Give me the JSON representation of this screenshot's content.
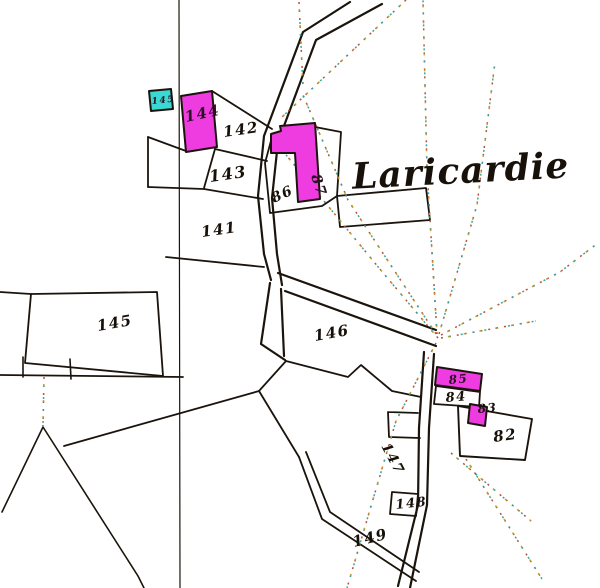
{
  "map": {
    "title_label": "Laricardie",
    "colors": {
      "paper": "#ffffff",
      "ink": "#1b140c",
      "building_magenta": "#ee3ce1",
      "building_cyan": "#3bd9d4",
      "label_ink": "#171008",
      "label_on_magenta": "#2a1022",
      "dotted_red": "#b14a28",
      "dotted_teal": "#2fa39a",
      "dotted_yellow": "#c49b25"
    },
    "parcel_labels": [
      {
        "name": "parcel-label-144",
        "text": "144",
        "x": 186,
        "y": 122,
        "rot": -12,
        "size": 15,
        "on_building": true
      },
      {
        "name": "parcel-label-142",
        "text": "142",
        "x": 224,
        "y": 137,
        "rot": -8,
        "size": 15,
        "on_building": false
      },
      {
        "name": "parcel-label-143",
        "text": "143",
        "x": 210,
        "y": 182,
        "rot": -8,
        "size": 16,
        "on_building": false
      },
      {
        "name": "parcel-label-141",
        "text": "141",
        "x": 202,
        "y": 237,
        "rot": -8,
        "size": 15,
        "on_building": false
      },
      {
        "name": "parcel-label-86",
        "text": "86",
        "x": 274,
        "y": 203,
        "rot": -25,
        "size": 14,
        "on_building": false
      },
      {
        "name": "parcel-label-87",
        "text": "87",
        "x": 311,
        "y": 176,
        "rot": 72,
        "size": 14,
        "on_building": true
      },
      {
        "name": "parcel-label-145",
        "text": "145",
        "x": 98,
        "y": 331,
        "rot": -10,
        "size": 15,
        "on_building": false
      },
      {
        "name": "building-label-145",
        "text": "145",
        "x": 152,
        "y": 104,
        "rot": -6,
        "size": 9,
        "on_building": true
      },
      {
        "name": "parcel-label-146",
        "text": "146",
        "x": 315,
        "y": 341,
        "rot": -10,
        "size": 15,
        "on_building": false
      },
      {
        "name": "parcel-label-147",
        "text": "147",
        "x": 381,
        "y": 446,
        "rot": 62,
        "size": 14,
        "on_building": false
      },
      {
        "name": "parcel-label-148",
        "text": "148",
        "x": 396,
        "y": 509,
        "rot": -6,
        "size": 13,
        "on_building": false
      },
      {
        "name": "parcel-label-149",
        "text": "149",
        "x": 354,
        "y": 547,
        "rot": -14,
        "size": 15,
        "on_building": false
      },
      {
        "name": "parcel-label-85",
        "text": "85",
        "x": 449,
        "y": 384,
        "rot": -5,
        "size": 12,
        "on_building": true
      },
      {
        "name": "parcel-label-84",
        "text": "84",
        "x": 446,
        "y": 402,
        "rot": -5,
        "size": 13,
        "on_building": false
      },
      {
        "name": "parcel-label-83",
        "text": "83",
        "x": 478,
        "y": 413,
        "rot": -5,
        "size": 12,
        "on_building": false
      },
      {
        "name": "parcel-label-82",
        "text": "82",
        "x": 494,
        "y": 442,
        "rot": -8,
        "size": 15,
        "on_building": false
      }
    ],
    "roads": [
      {
        "name": "road-main-west-edge",
        "d": "M350,2 L303,32 L264,136 L258,196 L264,254 L271,280"
      },
      {
        "name": "road-main-east-edge",
        "d": "M382,4 L316,40 L278,142 L272,198 L277,254 L282,285"
      },
      {
        "name": "road-branch-north-edge",
        "d": "M278,273 L436,330"
      },
      {
        "name": "road-branch-south-edge",
        "d": "M285,291 L436,346"
      },
      {
        "name": "road-south-west-edge",
        "d": "M270,283 L261,344 L285,360"
      },
      {
        "name": "road-south-east-edge",
        "d": "M281,289 L284,356"
      },
      {
        "name": "road-down-west-edge",
        "d": "M424,352 L419,428 L418,505 L398,586"
      },
      {
        "name": "road-down-east-edge",
        "d": "M434,354 L429,428 L427,505 L410,588"
      }
    ],
    "boundaries": [
      {
        "name": "section-line-vertical",
        "d": "M179,0 L180,588",
        "w": 1.2
      },
      {
        "name": "boundary-142-top",
        "d": "M212,91 L272,129",
        "w": 1.8
      },
      {
        "name": "boundary-142-143",
        "d": "M215,149 L267,161",
        "w": 1.8
      },
      {
        "name": "boundary-143-left",
        "d": "M215,149 L204,188",
        "w": 1.8
      },
      {
        "name": "boundary-143-bottom",
        "d": "M148,187 L204,189 L263,199",
        "w": 1.8
      },
      {
        "name": "boundary-left-small-vertical",
        "d": "M148,137 L148,187",
        "w": 1.8
      },
      {
        "name": "boundary-left-small-diagonal",
        "d": "M148,137 L186,151",
        "w": 1.8
      },
      {
        "name": "boundary-141-bottom",
        "d": "M166,257 L264,267",
        "w": 1.8
      },
      {
        "name": "plot-86-outline",
        "d": "M265,163 L272,137 L315,127 L341,132 L337,196 L322,206 L270,213 Z",
        "w": 1.8
      },
      {
        "name": "plot-86-right-outline",
        "d": "M337,196 L426,188 L430,220 L340,227 Z",
        "w": 1.8
      },
      {
        "name": "boundary-146-south-zigzag",
        "d": "M286,361 L348,377 L361,365 L392,391 L421,397",
        "w": 1.8
      },
      {
        "name": "boundary-149-north",
        "d": "M64,446 L259,391 L286,361",
        "w": 1.8
      },
      {
        "name": "boundary-147-west",
        "d": "M259,391 L299,457",
        "w": 1.8
      },
      {
        "name": "path-149-southeast-a",
        "d": "M299,457 L322,519 L416,581",
        "w": 1.8
      },
      {
        "name": "path-149-southeast-b",
        "d": "M306,452 L330,512 L419,572",
        "w": 1.8
      },
      {
        "name": "boundary-bottomleft-horizontal",
        "d": "M0,375 L183,377",
        "w": 1.8
      },
      {
        "name": "boundary-tick-a",
        "d": "M23,357 L23,377",
        "w": 1.6
      },
      {
        "name": "boundary-tick-b",
        "d": "M70,359 L71,379",
        "w": 1.6
      },
      {
        "name": "parcel-145-outline",
        "d": "M31,294 L157,292 L163,376 L25,363 Z",
        "w": 1.8
      },
      {
        "name": "boundary-145-west-extension",
        "d": "M0,292 L31,294",
        "w": 1.8
      },
      {
        "name": "boundary-v-lines",
        "d": "M2,512 L43,427 L138,576 L144,588",
        "w": 1.6
      },
      {
        "name": "parcel-148-outline",
        "d": "M392,492 L418,494 L416,516 L390,514 Z",
        "w": 1.8
      },
      {
        "name": "parcel-147-notch",
        "d": "M388,412 L418,413 M388,412 L389,437 L420,438",
        "w": 1.8
      },
      {
        "name": "parcel-82-outline",
        "d": "M458,406 L532,419 L525,460 L460,456 Z",
        "w": 1.9
      },
      {
        "name": "parcel-84-outline",
        "d": "M436,386 L480,392 L479,407 L434,404 Z",
        "w": 1.8
      }
    ],
    "buildings": [
      {
        "name": "building-144",
        "points": "181,96 212,91 217,147 186,152",
        "fill": "magenta"
      },
      {
        "name": "building-86-87",
        "points": "271,134 281,131 280,126 315,123 320,199 298,202 295,153 271,153",
        "fill": "magenta"
      },
      {
        "name": "building-145-cyan",
        "points": "149,91 171,89 173,109 151,111",
        "fill": "cyan"
      },
      {
        "name": "building-85",
        "points": "437,367 482,374 480,391 435,385",
        "fill": "magenta"
      },
      {
        "name": "building-83",
        "points": "470,404 487,407 485,426 468,423",
        "fill": "magenta"
      }
    ],
    "dotted_lines": [
      {
        "name": "dotted-junction-north",
        "d": "M437,334 L427,170 L423,0"
      },
      {
        "name": "dotted-junction-north-northeast",
        "d": "M439,334 L477,205 L495,62"
      },
      {
        "name": "dotted-junction-to-road-bend",
        "d": "M436,334 L348,200 L303,95"
      },
      {
        "name": "dotted-junction-east",
        "d": "M441,338 L536,321"
      },
      {
        "name": "dotted-junction-northeast",
        "d": "M441,335 L560,272 L598,243"
      },
      {
        "name": "dotted-junction-south-southwest",
        "d": "M436,343 L396,421 L347,588"
      },
      {
        "name": "dotted-82-southeast-a",
        "d": "M451,453 L531,521"
      },
      {
        "name": "dotted-82-southeast-b",
        "d": "M466,459 L542,579"
      },
      {
        "name": "dotted-top-diagonal",
        "d": "M406,0 L281,118"
      },
      {
        "name": "dotted-top-vertical",
        "d": "M299,2 L303,86"
      },
      {
        "name": "dotted-v-apex-vertical",
        "d": "M44,377 L43,426"
      },
      {
        "name": "dotted-junction-upleft",
        "d": "M438,338 L379,268 L273,139"
      }
    ]
  }
}
